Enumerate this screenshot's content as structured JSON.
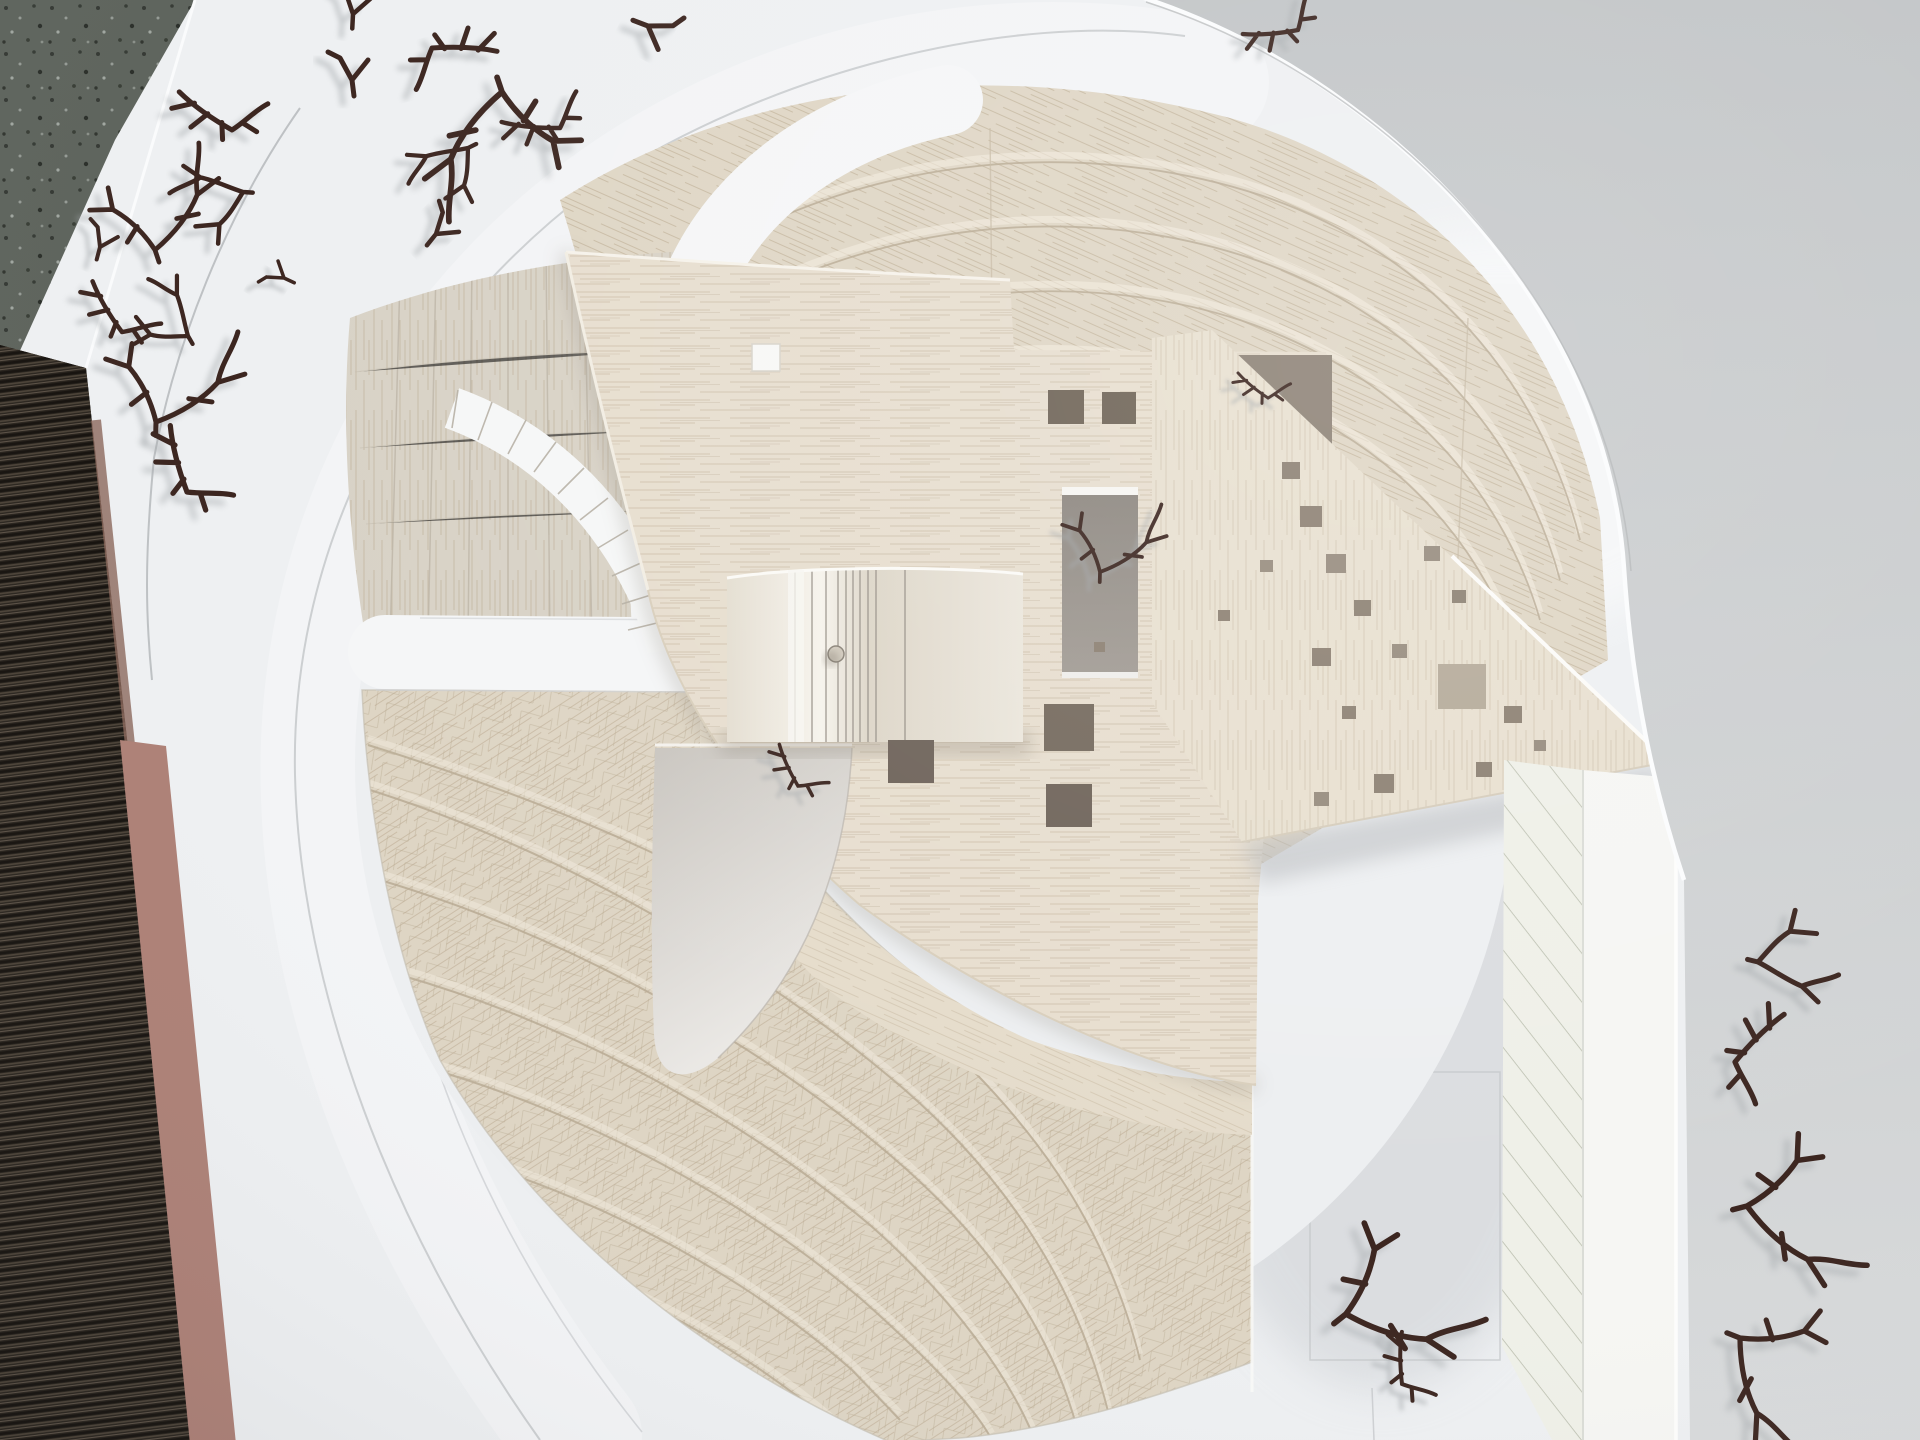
{
  "scene": {
    "subject": "top-down photograph of a physical architecture site model",
    "materials": "balsa wood terraces and roofs, white foam board base, dried twigs as trees",
    "setting": "model lying on a gray table; striped dark wood mat and terrazzo floor visible at left edge"
  },
  "palette": {
    "table_gray": "#c2c5c7",
    "table_light": "#d8dadb",
    "floor_terrazzo": "#5d635c",
    "mat_dark": "#241f19",
    "salmon_strip": "#ad8076",
    "board_white": "#eef0f2",
    "ring_white": "#f3f4f6",
    "road_white": "#f5f6f7",
    "parking_white": "#f6f7f7",
    "fan_top": "#dfd6c5",
    "fan_upper_left": "#d8d2c6",
    "fan_lower": "#ded5c4",
    "quarter_plate": "#e5dccb",
    "roof_balsa": "#e7decf",
    "wedge_balsa": "#e8e0d0",
    "tower_face": "#ece7db",
    "tower_side": "#e8e3d9",
    "courtyard_dark": "#948e88",
    "courtyard_light": "#d9d6d1",
    "triangle_gap": "#8d8276",
    "white_skylight": "#f7f7f6",
    "hatch_road": "#eff0e8",
    "hatch_line": "#b8bcac",
    "edge_strip": "#f6f6f3",
    "seam_brown": "#b9ab94",
    "twig_brown": "#3c2620",
    "twig_shadow": "#a3a7aa",
    "edge_light": "#fbfcfd",
    "incised_line": "#aeb1b4"
  },
  "model": {
    "base_board": {
      "name": "white foam base board",
      "shape": "rounded square with curved corner"
    },
    "ring_road": {
      "name": "raised white ring walkway",
      "band_width_px": 128
    },
    "roads": {
      "count": 2,
      "description": "white channels from ring to center, T junction at left"
    },
    "parking_ticks": {
      "count": 10,
      "description": "curved stall strip with tick marks"
    },
    "terraces": {
      "top_fan_bands": 8,
      "upper_left_bands": 7,
      "lower_fan_bands": 7,
      "description": "curved stepped balsa landscape bands"
    },
    "tower": {
      "name": "small striped balsa box on roof",
      "pin": true
    },
    "courtyards": {
      "tall_rect": 1,
      "triangle": 1,
      "quarter_circle": 1
    },
    "service_road": {
      "description": "hatched vertical road at right with raised white edge strip"
    }
  },
  "perforations": {
    "count": 23,
    "items": [
      {
        "x": 1048,
        "y": 390,
        "s": 36,
        "c": "#6f6457"
      },
      {
        "x": 1102,
        "y": 392,
        "s": 34,
        "c": "#6f6457"
      },
      {
        "x": 888,
        "y": 740,
        "s": 46,
        "c": "#6e635a"
      },
      {
        "x": 1044,
        "y": 704,
        "s": 50,
        "c": "#756a5e"
      },
      {
        "x": 1046,
        "y": 784,
        "s": 46,
        "c": "#6f645a"
      },
      {
        "x": 1300,
        "y": 506,
        "s": 22,
        "c": "#8d8173"
      },
      {
        "x": 1326,
        "y": 554,
        "s": 20,
        "c": "#978c7e"
      },
      {
        "x": 1354,
        "y": 600,
        "s": 17,
        "c": "#8d8173"
      },
      {
        "x": 1312,
        "y": 648,
        "s": 19,
        "c": "#8d8173"
      },
      {
        "x": 1392,
        "y": 644,
        "s": 15,
        "c": "#978c7e"
      },
      {
        "x": 1342,
        "y": 706,
        "s": 14,
        "c": "#8d8173"
      },
      {
        "x": 1424,
        "y": 546,
        "s": 16,
        "c": "#978c7e"
      },
      {
        "x": 1452,
        "y": 590,
        "s": 14,
        "c": "#8d8173"
      },
      {
        "x": 1438,
        "y": 664,
        "s": 48,
        "c": "#b5ab9a"
      },
      {
        "x": 1504,
        "y": 706,
        "s": 18,
        "c": "#8d8173"
      },
      {
        "x": 1476,
        "y": 762,
        "s": 16,
        "c": "#8d8173"
      },
      {
        "x": 1534,
        "y": 740,
        "s": 12,
        "c": "#978c7e"
      },
      {
        "x": 1374,
        "y": 774,
        "s": 20,
        "c": "#8d8173"
      },
      {
        "x": 1314,
        "y": 792,
        "s": 15,
        "c": "#978c7e"
      },
      {
        "x": 1094,
        "y": 642,
        "s": 11,
        "c": "#8d8173"
      },
      {
        "x": 1282,
        "y": 462,
        "s": 18,
        "c": "#8d8173"
      },
      {
        "x": 1260,
        "y": 560,
        "s": 13,
        "c": "#978c7e"
      },
      {
        "x": 1218,
        "y": 610,
        "s": 12,
        "c": "#8d8173"
      }
    ]
  },
  "trees": {
    "count": 27,
    "material": "dried twigs",
    "items": [
      {
        "x": 353,
        "y": 14,
        "r": 10,
        "s": 0.9,
        "v": "d"
      },
      {
        "x": 432,
        "y": 48,
        "r": -15,
        "s": 1.0,
        "v": "b"
      },
      {
        "x": 502,
        "y": 92,
        "r": 8,
        "s": 1.15,
        "v": "c"
      },
      {
        "x": 560,
        "y": 128,
        "r": 168,
        "s": 0.9,
        "v": "b"
      },
      {
        "x": 468,
        "y": 148,
        "r": 42,
        "s": 0.85,
        "v": "a"
      },
      {
        "x": 352,
        "y": 80,
        "r": 0,
        "s": 1.0,
        "v": "d"
      },
      {
        "x": 648,
        "y": 26,
        "r": 118,
        "s": 1.0,
        "v": "d"
      },
      {
        "x": 1298,
        "y": 30,
        "r": 158,
        "s": 0.85,
        "v": "b"
      },
      {
        "x": 232,
        "y": 130,
        "r": 198,
        "s": 1.0,
        "v": "b"
      },
      {
        "x": 243,
        "y": 192,
        "r": 72,
        "s": 0.9,
        "v": "a"
      },
      {
        "x": 155,
        "y": 250,
        "r": 188,
        "s": 0.95,
        "v": "c"
      },
      {
        "x": 100,
        "y": 247,
        "r": 22,
        "s": 0.8,
        "v": "d"
      },
      {
        "x": 122,
        "y": 332,
        "r": 222,
        "s": 0.9,
        "v": "b"
      },
      {
        "x": 188,
        "y": 336,
        "r": 128,
        "s": 0.85,
        "v": "a"
      },
      {
        "x": 156,
        "y": 422,
        "r": 208,
        "s": 1.0,
        "v": "c"
      },
      {
        "x": 187,
        "y": 492,
        "r": 238,
        "s": 1.05,
        "v": "b"
      },
      {
        "x": 436,
        "y": 234,
        "r": 46,
        "s": 0.9,
        "v": "d"
      },
      {
        "x": 284,
        "y": 278,
        "r": 302,
        "s": 0.7,
        "v": "d"
      },
      {
        "x": 1758,
        "y": 962,
        "r": 262,
        "s": 1.0,
        "v": "a"
      },
      {
        "x": 1735,
        "y": 1062,
        "r": 298,
        "s": 1.05,
        "v": "b"
      },
      {
        "x": 1747,
        "y": 1206,
        "r": 282,
        "s": 1.1,
        "v": "c"
      },
      {
        "x": 1740,
        "y": 1338,
        "r": 318,
        "s": 1.05,
        "v": "c"
      },
      {
        "x": 1402,
        "y": 1384,
        "r": 252,
        "s": 0.8,
        "v": "b"
      },
      {
        "x": 1346,
        "y": 1314,
        "r": 258,
        "s": 1.15,
        "v": "c"
      },
      {
        "x": 1100,
        "y": 572,
        "r": 208,
        "s": 0.75,
        "v": "c"
      },
      {
        "x": 1268,
        "y": 398,
        "r": 202,
        "s": 0.6,
        "v": "b"
      },
      {
        "x": 798,
        "y": 786,
        "r": 228,
        "s": 0.7,
        "v": "b"
      }
    ]
  }
}
